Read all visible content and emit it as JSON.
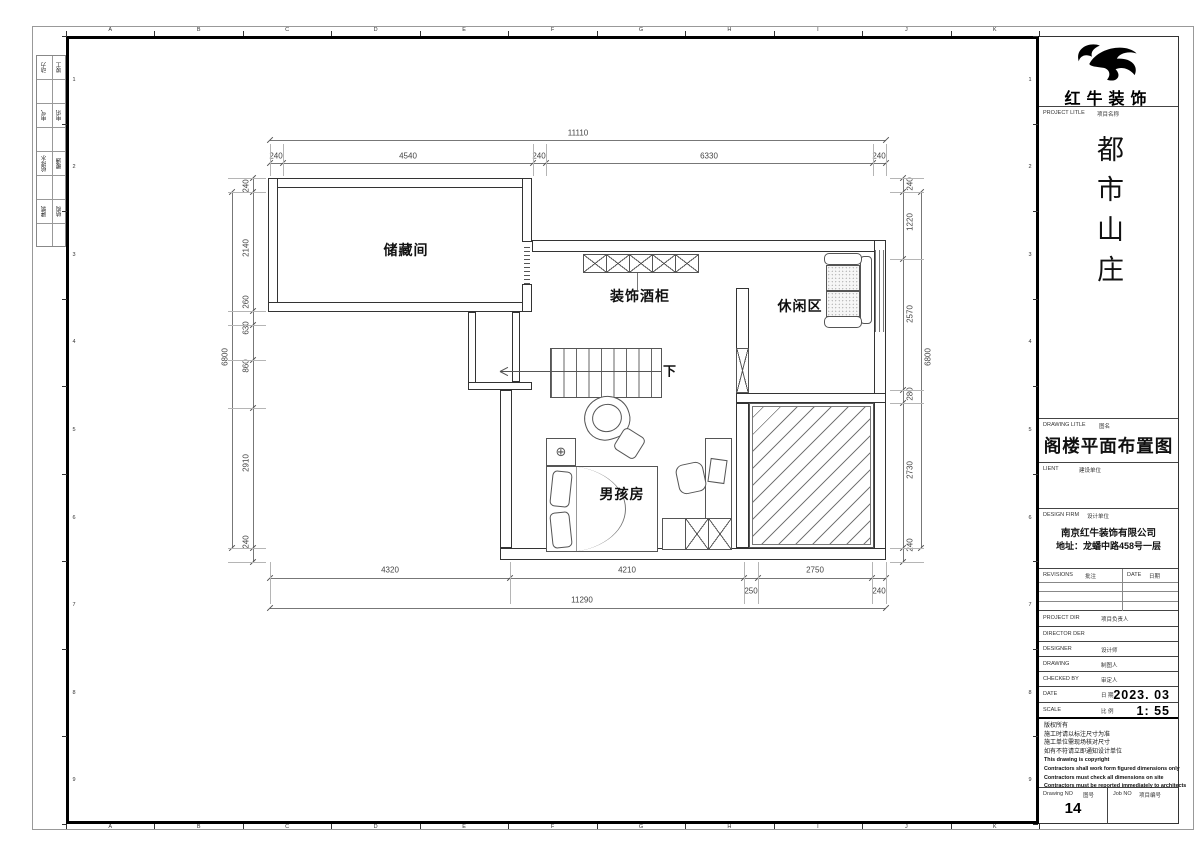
{
  "sheet": {
    "grid_letters": [
      "A",
      "B",
      "C",
      "D",
      "E",
      "F",
      "G",
      "H",
      "I",
      "J",
      "K"
    ],
    "grid_numbers": [
      "1",
      "2",
      "3",
      "4",
      "5",
      "6",
      "7",
      "8",
      "9"
    ],
    "margin_table": [
      [
        "动力",
        "竣工"
      ],
      [
        "电气",
        "电讯"
      ],
      [
        "给排水",
        "暖通"
      ],
      [
        "建筑",
        "结构"
      ]
    ]
  },
  "plan": {
    "rooms": {
      "storage": "储藏间",
      "wine_cabinet": "装饰酒柜",
      "leisure": "休闲区",
      "boy_room": "男孩房",
      "stairs_down": "下"
    },
    "dims": {
      "top_total": "11110",
      "top": [
        "240",
        "4540",
        "240",
        "6330",
        "240"
      ],
      "bottom": [
        "4320",
        "4210",
        "250",
        "2750",
        "240"
      ],
      "bottom_total": "11290",
      "left": [
        "240",
        "2140",
        "260",
        "630",
        "860",
        "2910",
        "240"
      ],
      "left_total": "6800",
      "right": [
        "240",
        "1220",
        "2570",
        "280",
        "2730",
        "240"
      ],
      "right_total": "6800"
    }
  },
  "titleblock": {
    "logo_text": "红牛装饰",
    "project_label": "PROJECT LITLE",
    "project_label_cn": "项目名称",
    "project_title": "都市山庄",
    "drawing_label": "DRAWING LITLE",
    "drawing_label_cn": "图名",
    "drawing_title": "阁楼平面布置图",
    "client_label": "LIENT",
    "client_label_cn": "建设单位",
    "firm_label": "DESIGN FIRM",
    "firm_label_cn": "设计单位",
    "firm_name": "南京红牛装饰有限公司",
    "firm_address": "地址：龙蟠中路458号一层",
    "revisions_label": "REVISIONS",
    "revisions_label_cn": "批注",
    "date_col_label": "DATE",
    "date_col_label_cn": "日期",
    "rows": [
      {
        "en": "PROJECT DIR",
        "cn": "项目负责人",
        "value": ""
      },
      {
        "en": "DIRECTOR DER",
        "cn": "",
        "value": ""
      },
      {
        "en": "DESIGNER",
        "cn": "设计师",
        "value": ""
      },
      {
        "en": "DRAWING",
        "cn": "制图人",
        "value": ""
      },
      {
        "en": "CHECKED BY",
        "cn": "审定人",
        "value": ""
      },
      {
        "en": "DATE",
        "cn": "日 期",
        "value": "2023. 03"
      },
      {
        "en": "SCALE",
        "cn": "比 例",
        "value": "1: 55"
      }
    ],
    "copyright_lines": [
      "版权所有",
      "施工时请以标注尺寸为准",
      "施工单位需现场核对尺寸",
      "如有不符请立即通知设计单位",
      "This drawing is copyright",
      "Contractors shall work form figured dimensions only",
      "Contractors must check all dimensions on site",
      "Contractors must be reported immediately to architects"
    ],
    "drawing_no_label": "Drawing NO",
    "drawing_no_label_cn": "图号",
    "drawing_no": "14",
    "job_no_label": "Job NO",
    "job_no_label_cn": "项目编号",
    "job_no": ""
  }
}
